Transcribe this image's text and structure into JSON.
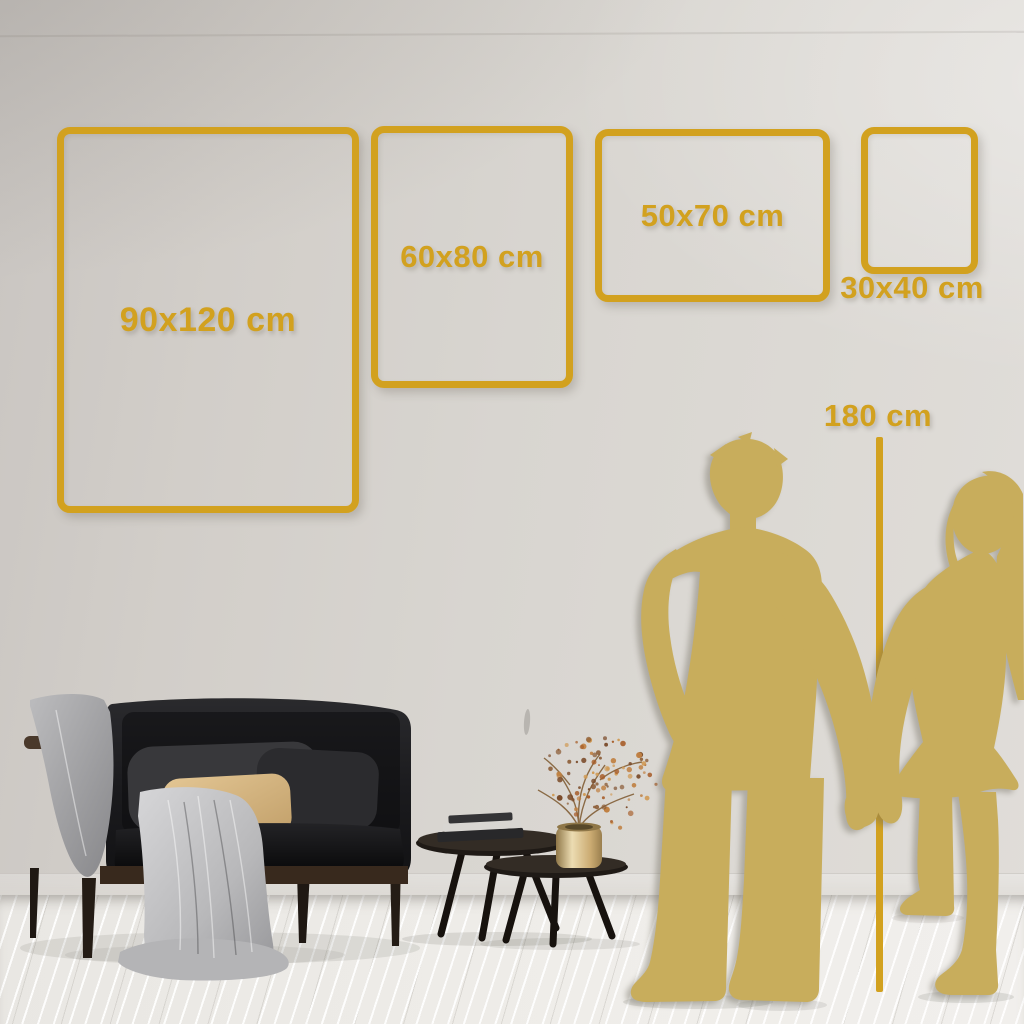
{
  "size_guide": {
    "frames": [
      {
        "label": "90x120 cm",
        "orientation": "portrait",
        "label_position": "inside"
      },
      {
        "label": "60x80 cm",
        "orientation": "portrait",
        "label_position": "inside"
      },
      {
        "label": "50x70 cm",
        "orientation": "landscape",
        "label_position": "inside"
      },
      {
        "label": "30x40 cm",
        "orientation": "portrait",
        "label_position": "below"
      }
    ],
    "height_reference": {
      "label": "180 cm"
    }
  },
  "colors": {
    "accent_gold": "#d2a11f",
    "silhouette_gold": "#c8ad5c",
    "wall": "#d8d4cf",
    "floor": "#edebe7"
  }
}
